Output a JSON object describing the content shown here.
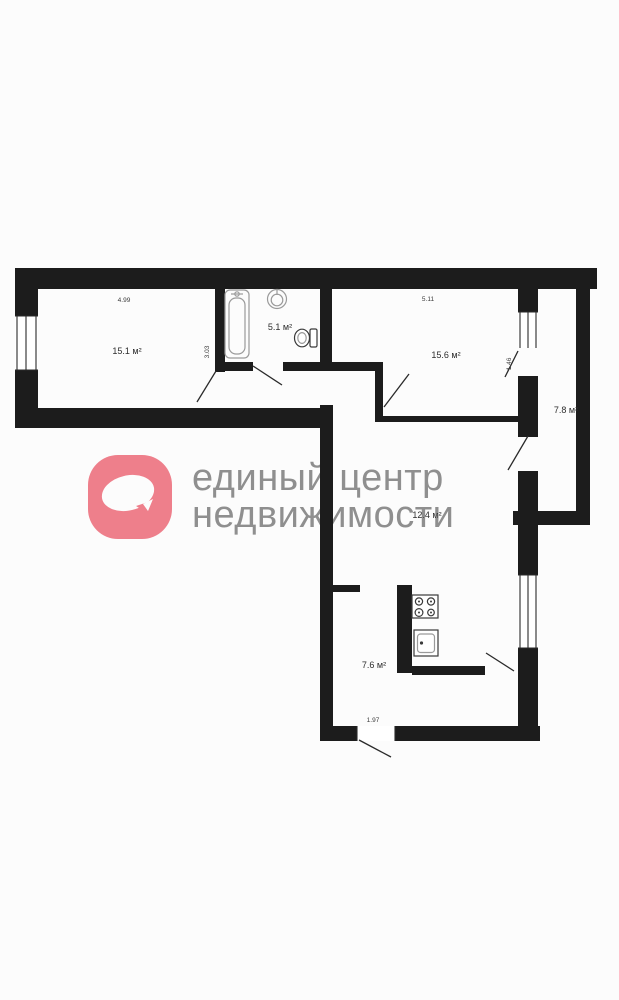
{
  "watermark": {
    "brand_line1": "единый центр",
    "brand_line2": "недвижимости",
    "logo_color": "#ee7f8b",
    "text_color": "#8f8f8f"
  },
  "plan": {
    "wall_color": "#1c1c1c",
    "rooms": {
      "living": {
        "area_label": "15.1 м²"
      },
      "bathroom": {
        "area_label": "5.1 м²"
      },
      "bedroom": {
        "area_label": "15.6 м²"
      },
      "loggia": {
        "area_label": "7.8 м²"
      },
      "hallway": {
        "area_label": "12.4 м²"
      },
      "kitchen": {
        "area_label": "7.6 м²"
      }
    },
    "dimensions": {
      "living_width": "4.99",
      "living_depth": "3.03",
      "bedroom_width": "5.11",
      "balcony_door_width": "1.46",
      "kitchen_width": "1.97"
    },
    "fixtures": [
      "bathtub",
      "sink",
      "toilet",
      "stove",
      "kitchen-sink"
    ]
  }
}
